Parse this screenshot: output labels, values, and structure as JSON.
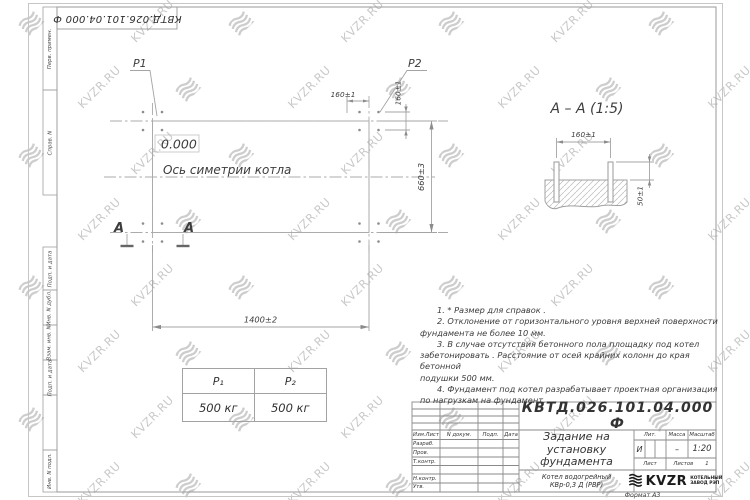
{
  "watermark": {
    "text": "KVZR.RU"
  },
  "sheet": {
    "stamp_top": "КВТД.026.101.04.000  Ф",
    "format_label": "Формат А3",
    "margin_labels": [
      "Перв. примен.",
      "Справ. N",
      "Подп. и дата",
      "Инв. N дубл.",
      "Взам. инв. N",
      "Подп. и дата",
      "Инв. N подл."
    ]
  },
  "plan": {
    "p1_label": "P1",
    "p2_label": "P2",
    "elevation_mark": "0.000",
    "symmetry_axis_label": "Ось симетрии котла",
    "section_letter": "А",
    "dims": {
      "width": "1400±2",
      "depth": "660±3",
      "bolt_spacing_x": "160±1",
      "bolt_spacing_y": "160±1"
    }
  },
  "section_view": {
    "title": "А – А (1:5)",
    "dims": {
      "bolt_spacing": "160±1",
      "bolt_height": "50±1"
    }
  },
  "load_table": {
    "headers": [
      "P₁",
      "P₂"
    ],
    "values": [
      "500 кг",
      "500 кг"
    ]
  },
  "notes": {
    "lines": [
      "1.  * Размер для справок .",
      "2.  Отклонение от горизонтального уровня верхней поверхности",
      "фундамента не более  10  мм.",
      "3.  В случае отсутствия бетонного пола площадку под котел",
      "забетонировать .  Расстояние от осей крайних колонн до края бетонной",
      "подушки  500  мм.",
      "4.  Фундамент под котел разрабатывает проектная организация",
      "по нагрузкам на фундамент."
    ]
  },
  "title_block": {
    "doc_number": "КВТД.026.101.04.000  Ф",
    "title_lines": [
      "Задание на",
      "установку",
      "фундамента"
    ],
    "columns": [
      "Изм.Лист",
      "N докум.",
      "Подп.",
      "Дата"
    ],
    "rows": [
      "Разраб.",
      "Пров.",
      "Т.контр.",
      "Н.контр.",
      "Утв."
    ],
    "lit_label": "Лит.",
    "mass_label": "Масса",
    "scale_label": "Масштаб",
    "lit_value": "И",
    "mass_value": "–",
    "scale_value": "1:20",
    "sheet_label": "Лист",
    "sheets_label": "Листов",
    "sheets_value": "1",
    "product_lines": [
      "Котел водогрейный",
      "КВр-0,3  Д  (РВР)"
    ],
    "company_logo": "KVZR",
    "company_name_lines": [
      "КОТЕЛЬНЫЙ",
      "ЗАВОД РЭП"
    ]
  }
}
